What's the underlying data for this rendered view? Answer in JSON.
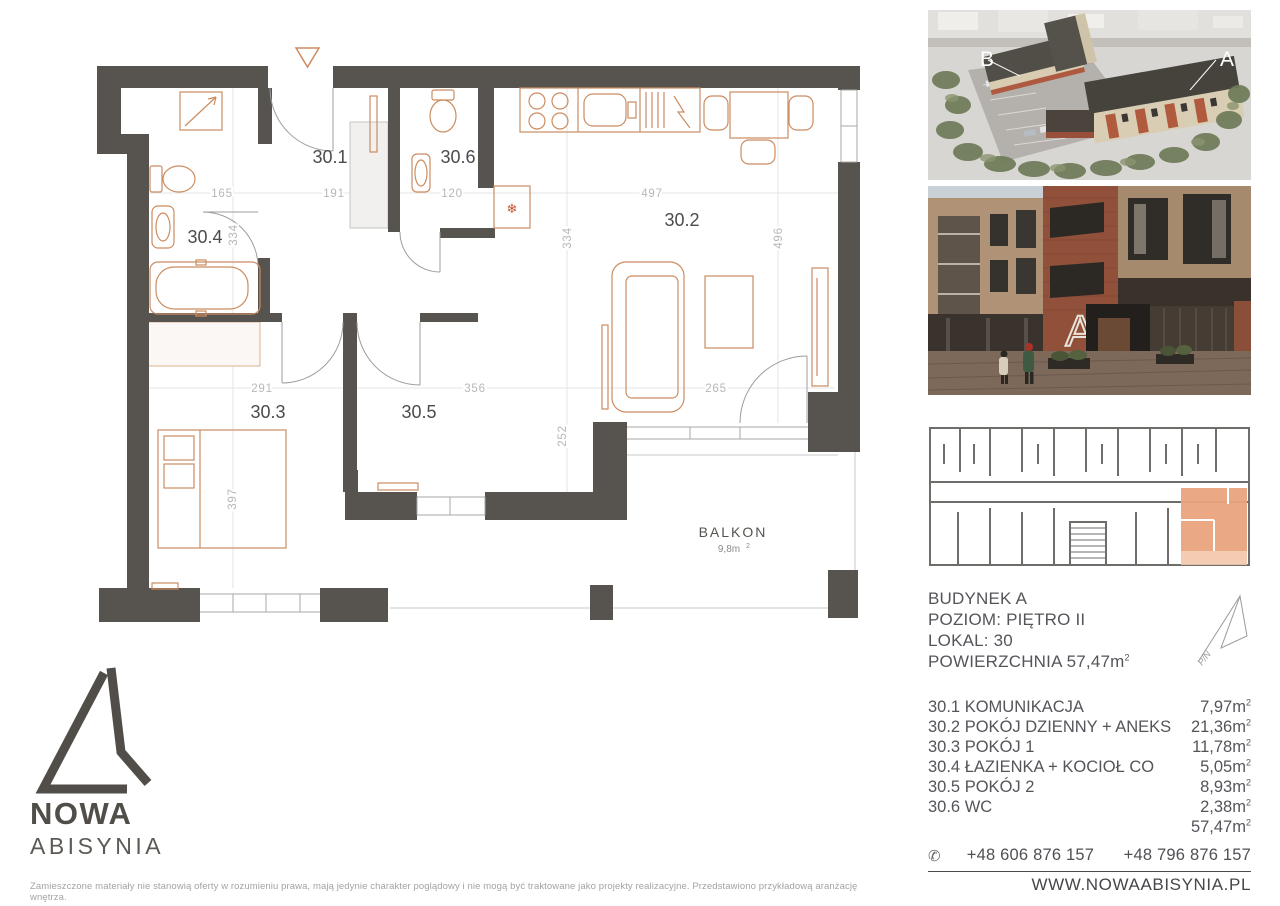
{
  "sup": "2",
  "floorplan": {
    "rooms": {
      "r1": "30.1",
      "r2": "30.2",
      "r3": "30.3",
      "r4": "30.4",
      "r5": "30.5",
      "r6": "30.6"
    },
    "dims": {
      "w165": "165",
      "w191": "191",
      "w120": "120",
      "w497": "497",
      "h334a": "334",
      "h334b": "334",
      "h496": "496",
      "w291": "291",
      "w356": "356",
      "w265": "265",
      "h252": "252",
      "h397": "397"
    },
    "balcony": {
      "label": "BALKON",
      "area": "9,8m"
    },
    "icons": {
      "fridge": "❄"
    }
  },
  "photos": {
    "aerial": {
      "label_b": "B",
      "label_a": "A"
    },
    "street": {
      "sign": "A"
    }
  },
  "info": {
    "line1": "BUDYNEK A",
    "line2": "POZIOM: PIĘTRO II",
    "line3": "LOKAL: 30",
    "line4": "POWIERZCHNIA 57,47m"
  },
  "compass": {
    "label": "P/N"
  },
  "rooms_table": {
    "rows": [
      {
        "no": "30.1",
        "name": "KOMUNIKACJA",
        "area": "7,97m"
      },
      {
        "no": "30.2",
        "name": "POKÓJ DZIENNY + ANEKS",
        "area": "21,36m"
      },
      {
        "no": "30.3",
        "name": "POKÓJ 1",
        "area": "11,78m"
      },
      {
        "no": "30.4",
        "name": "ŁAZIENKA + KOCIOŁ CO",
        "area": "5,05m"
      },
      {
        "no": "30.5",
        "name": "POKÓJ 2",
        "area": "8,93m"
      },
      {
        "no": "30.6",
        "name": "WC",
        "area": "2,38m"
      }
    ],
    "total": "57,47m"
  },
  "contact": {
    "phone_icon": "✆",
    "phone1": "+48 606 876 157",
    "phone2": "+48 796 876 157",
    "website": "WWW.NOWAABISYNIA.PL"
  },
  "brand": {
    "line1": "NOWA",
    "line2": "ABISYNIA"
  },
  "disclaimer": "Zamieszczone materiały nie stanowią oferty w rozumieniu prawa, mają jedynie charakter poglądowy i nie mogą być traktowane jako projekty realizacyjne. Przedstawiono przykładową aranżację wnętrza.",
  "colors": {
    "wall": "#57544f",
    "furniture": "#cc8c60",
    "unit_highlight": "#e9a47d"
  }
}
